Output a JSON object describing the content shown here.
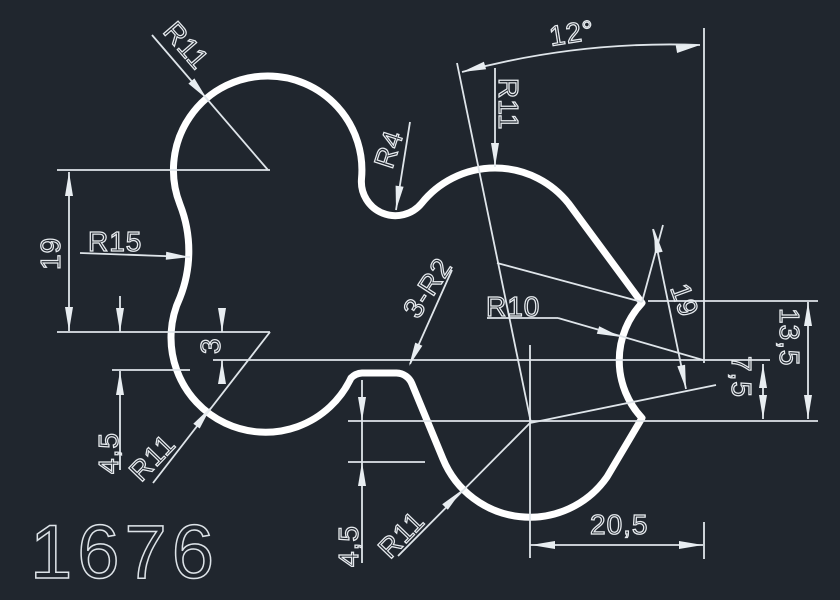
{
  "drawing": {
    "number": "1676",
    "colors": {
      "background": "#20262e",
      "outline": "#ffffff",
      "dimension": "#e7ebef"
    },
    "labels": {
      "r11_top_left": "R11",
      "r15_left": "R15",
      "r4_notch": "R4",
      "r11_top_right": "R11",
      "angle_12": "12°",
      "dim_19_left": "19",
      "dim_3": "3",
      "dim_45_left": "4,5",
      "r11_bottom_left": "R11",
      "fillet_3r2": "3-R2",
      "r10_notch": "R10",
      "dim_19_right": "19",
      "dim_135": "13,5",
      "dim_75": "7,5",
      "dim_45_bottom": "4,5",
      "r11_bottom_right": "R11",
      "dim_205": "20,5"
    }
  }
}
